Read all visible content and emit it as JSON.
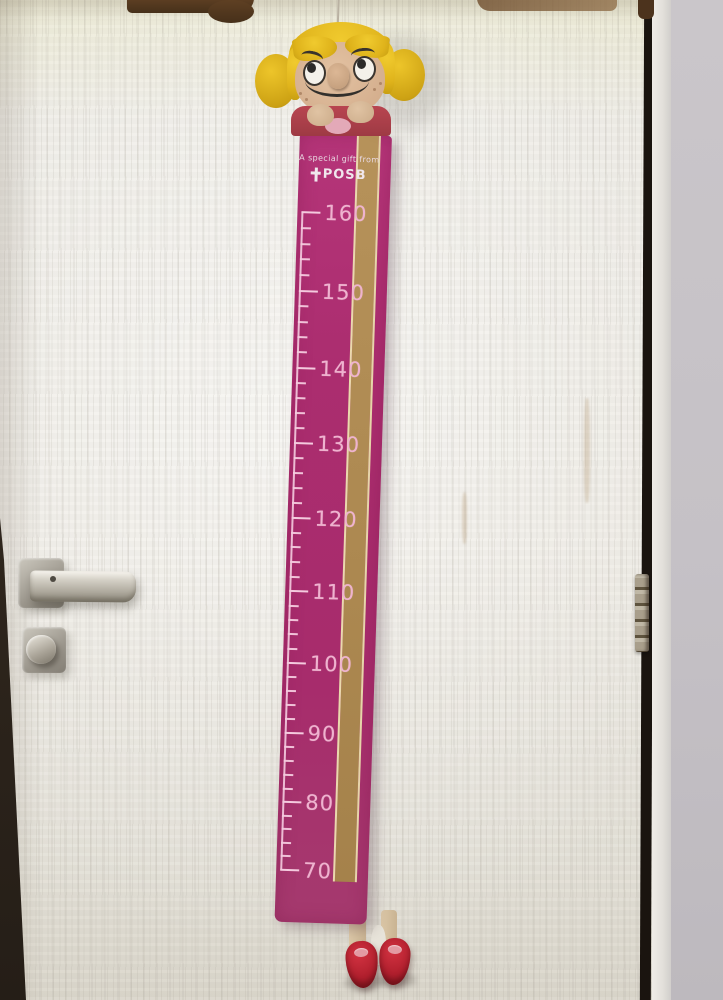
{
  "growth_chart": {
    "header": {
      "gift_text": "A special gift from",
      "brand": "POSB",
      "logo_icon": "posb-cross-logo"
    },
    "scale": {
      "labels": [
        "160",
        "150",
        "140",
        "130",
        "120",
        "110",
        "100",
        "90",
        "80",
        "70"
      ],
      "max": 160,
      "min": 70,
      "major_step": 10,
      "minor_step": 2
    },
    "colors": {
      "strip_pink": "#ab2e6f",
      "stripe_tan": "#b28e55",
      "stripe_cream": "#ead9ad",
      "markings_pink": "#f2c3d8",
      "doll_hair_yellow": "#e2b71e",
      "doll_outfit_red": "#b2434e",
      "shoe_red": "#c02532"
    }
  },
  "scene": {
    "door_color": "#eae7e0",
    "wall_color": "#c6c2c6",
    "frame_gap_color": "#1a140f",
    "hardware_color": "#a8a296"
  }
}
